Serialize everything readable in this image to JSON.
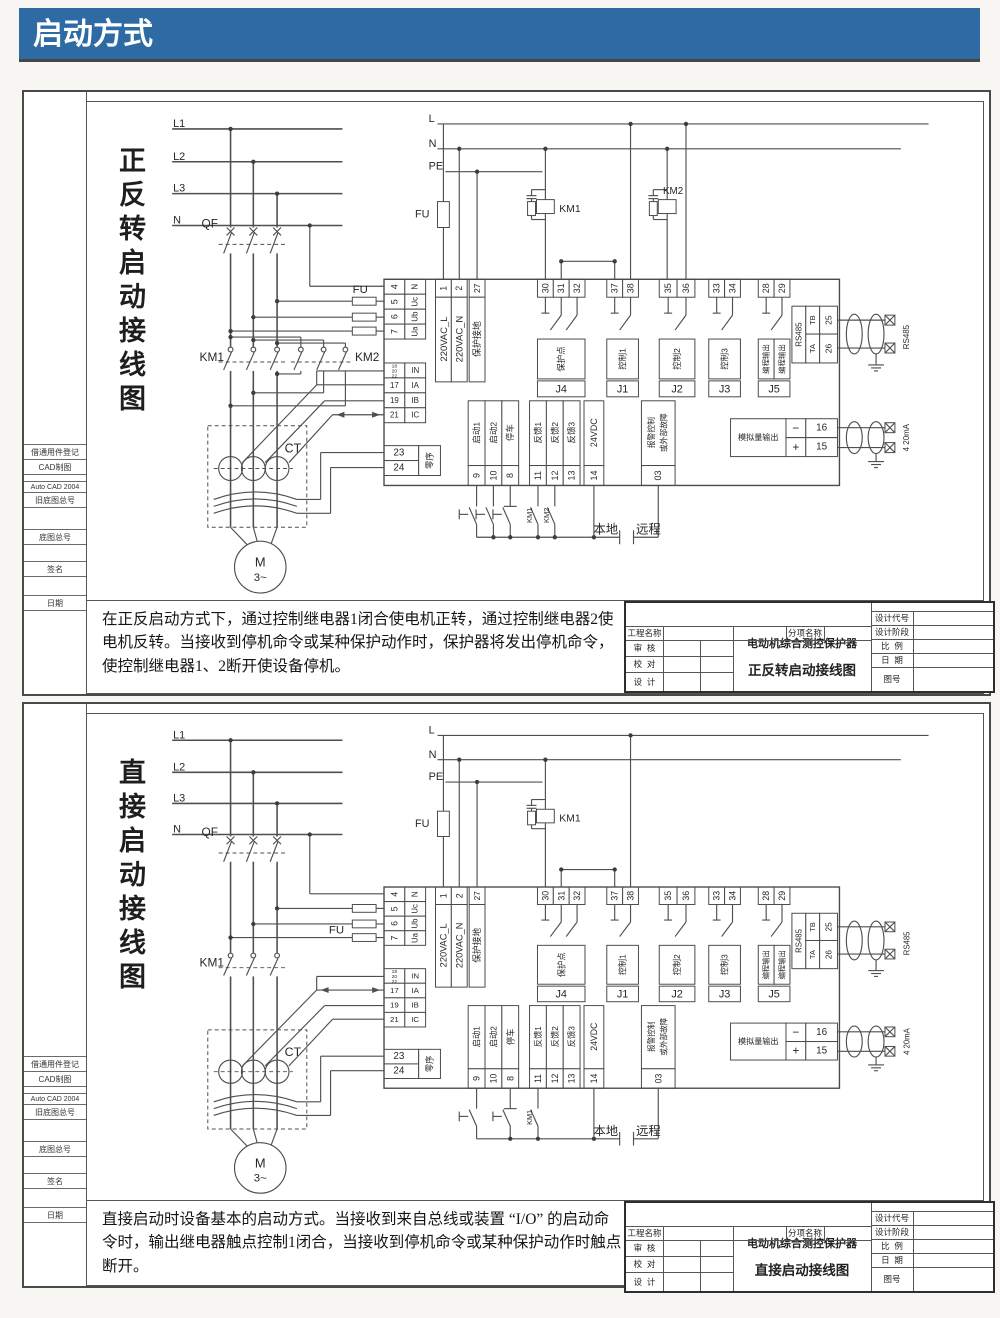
{
  "banner": {
    "title": "启动方式"
  },
  "colors": {
    "banner_bg": "#2e6ba4",
    "line": "#4f4f4f"
  },
  "sidebar": {
    "labels": [
      "借通用件登记",
      "CAD制图",
      "Auto CAD 2004",
      "旧底图总号",
      "底图总号",
      "签名",
      "日期"
    ]
  },
  "sh": {
    "L1": "L1",
    "L2": "L2",
    "L3": "L3",
    "N": "N",
    "L": "L",
    "PE": "PE",
    "QF": "QF",
    "FU": "FU",
    "CT": "CT",
    "KM1": "KM1",
    "KM2": "KM2",
    "M": "M",
    "M3": "3~",
    "local": "本地",
    "remote": "远程"
  },
  "t": {
    "n1": "1",
    "n2": "2",
    "n27": "27",
    "l220L": "220VAC_L",
    "l220N": "220VAC_N",
    "lpe": "保护接地",
    "n4": "4",
    "n5": "5",
    "n6": "6",
    "n7": "7",
    "lN": "N",
    "lUc": "Uc",
    "lUb": "Ub",
    "lUa": "Ua",
    "n18": "18",
    "n20": "20",
    "n22": "22",
    "lIN": "IN",
    "n17": "17",
    "lIA": "IA",
    "n19": "19",
    "lIB": "IB",
    "n21": "21",
    "lIC": "IC",
    "n23": "23",
    "n24": "24",
    "lzx": "零序",
    "n30": "30",
    "n31": "31",
    "n32": "32",
    "lJ4": "保护点",
    "J4": "J4",
    "n37": "37",
    "n38": "38",
    "lJ1": "控制1",
    "J1": "J1",
    "n35": "35",
    "n36": "36",
    "lJ2": "控制2",
    "J2": "J2",
    "n33": "33",
    "n34": "34",
    "lJ3": "控制3",
    "J3": "J3",
    "n28": "28",
    "n29": "29",
    "lJ5": "编程输出",
    "J5": "J5",
    "rs485": "RS485",
    "tb": "TB",
    "ta": "TA",
    "n25": "25",
    "n26": "26",
    "rs485x": "RS485",
    "analog": "模拟量输出",
    "minus": "−",
    "plus": "+",
    "n16": "16",
    "n15": "15",
    "ma420": "4 20mA",
    "n9": "9",
    "l9": "启动1",
    "n10": "10",
    "l10": "启动2",
    "n8": "8",
    "l8": "停车",
    "n11": "11",
    "l11": "反馈1",
    "n12": "12",
    "l12": "反馈2",
    "n13": "13",
    "l13": "反馈3",
    "n14": "14",
    "l14": "24VDC",
    "n03": "03",
    "l03a": "报警控制",
    "l03b": "或外部故障"
  },
  "tb": {
    "project": "工程名称",
    "subitem": "分项名称",
    "code": "设计代号",
    "stage": "设计阶段",
    "review": "审  核",
    "check": "校  对",
    "design": "设  计",
    "scale": "比  例",
    "date": "日  期",
    "fig": "图号"
  },
  "d1": {
    "side_title": "正反转启动接线图",
    "desc": "在正反启动方式下，通过控制继电器1闭合使电机正转，通过控制继电器2使电机反转。当接收到停机命令或某种保护动作时，保护器将发出停机命令，使控制继电器1、2断开使设备停机。",
    "product": "电动机综合测控保护器",
    "drawing": "正反转启动接线图"
  },
  "d2": {
    "side_title": "直接启动接线图",
    "desc": "直接启动时设备基本的启动方式。当接收到来自总线或装置 “I/O” 的启动命令时，输出继电器触点控制1闭合，当接收到停机命令或某种保护动作时触点断开。",
    "product": "电动机综合测控保护器",
    "drawing": "直接启动接线图"
  }
}
